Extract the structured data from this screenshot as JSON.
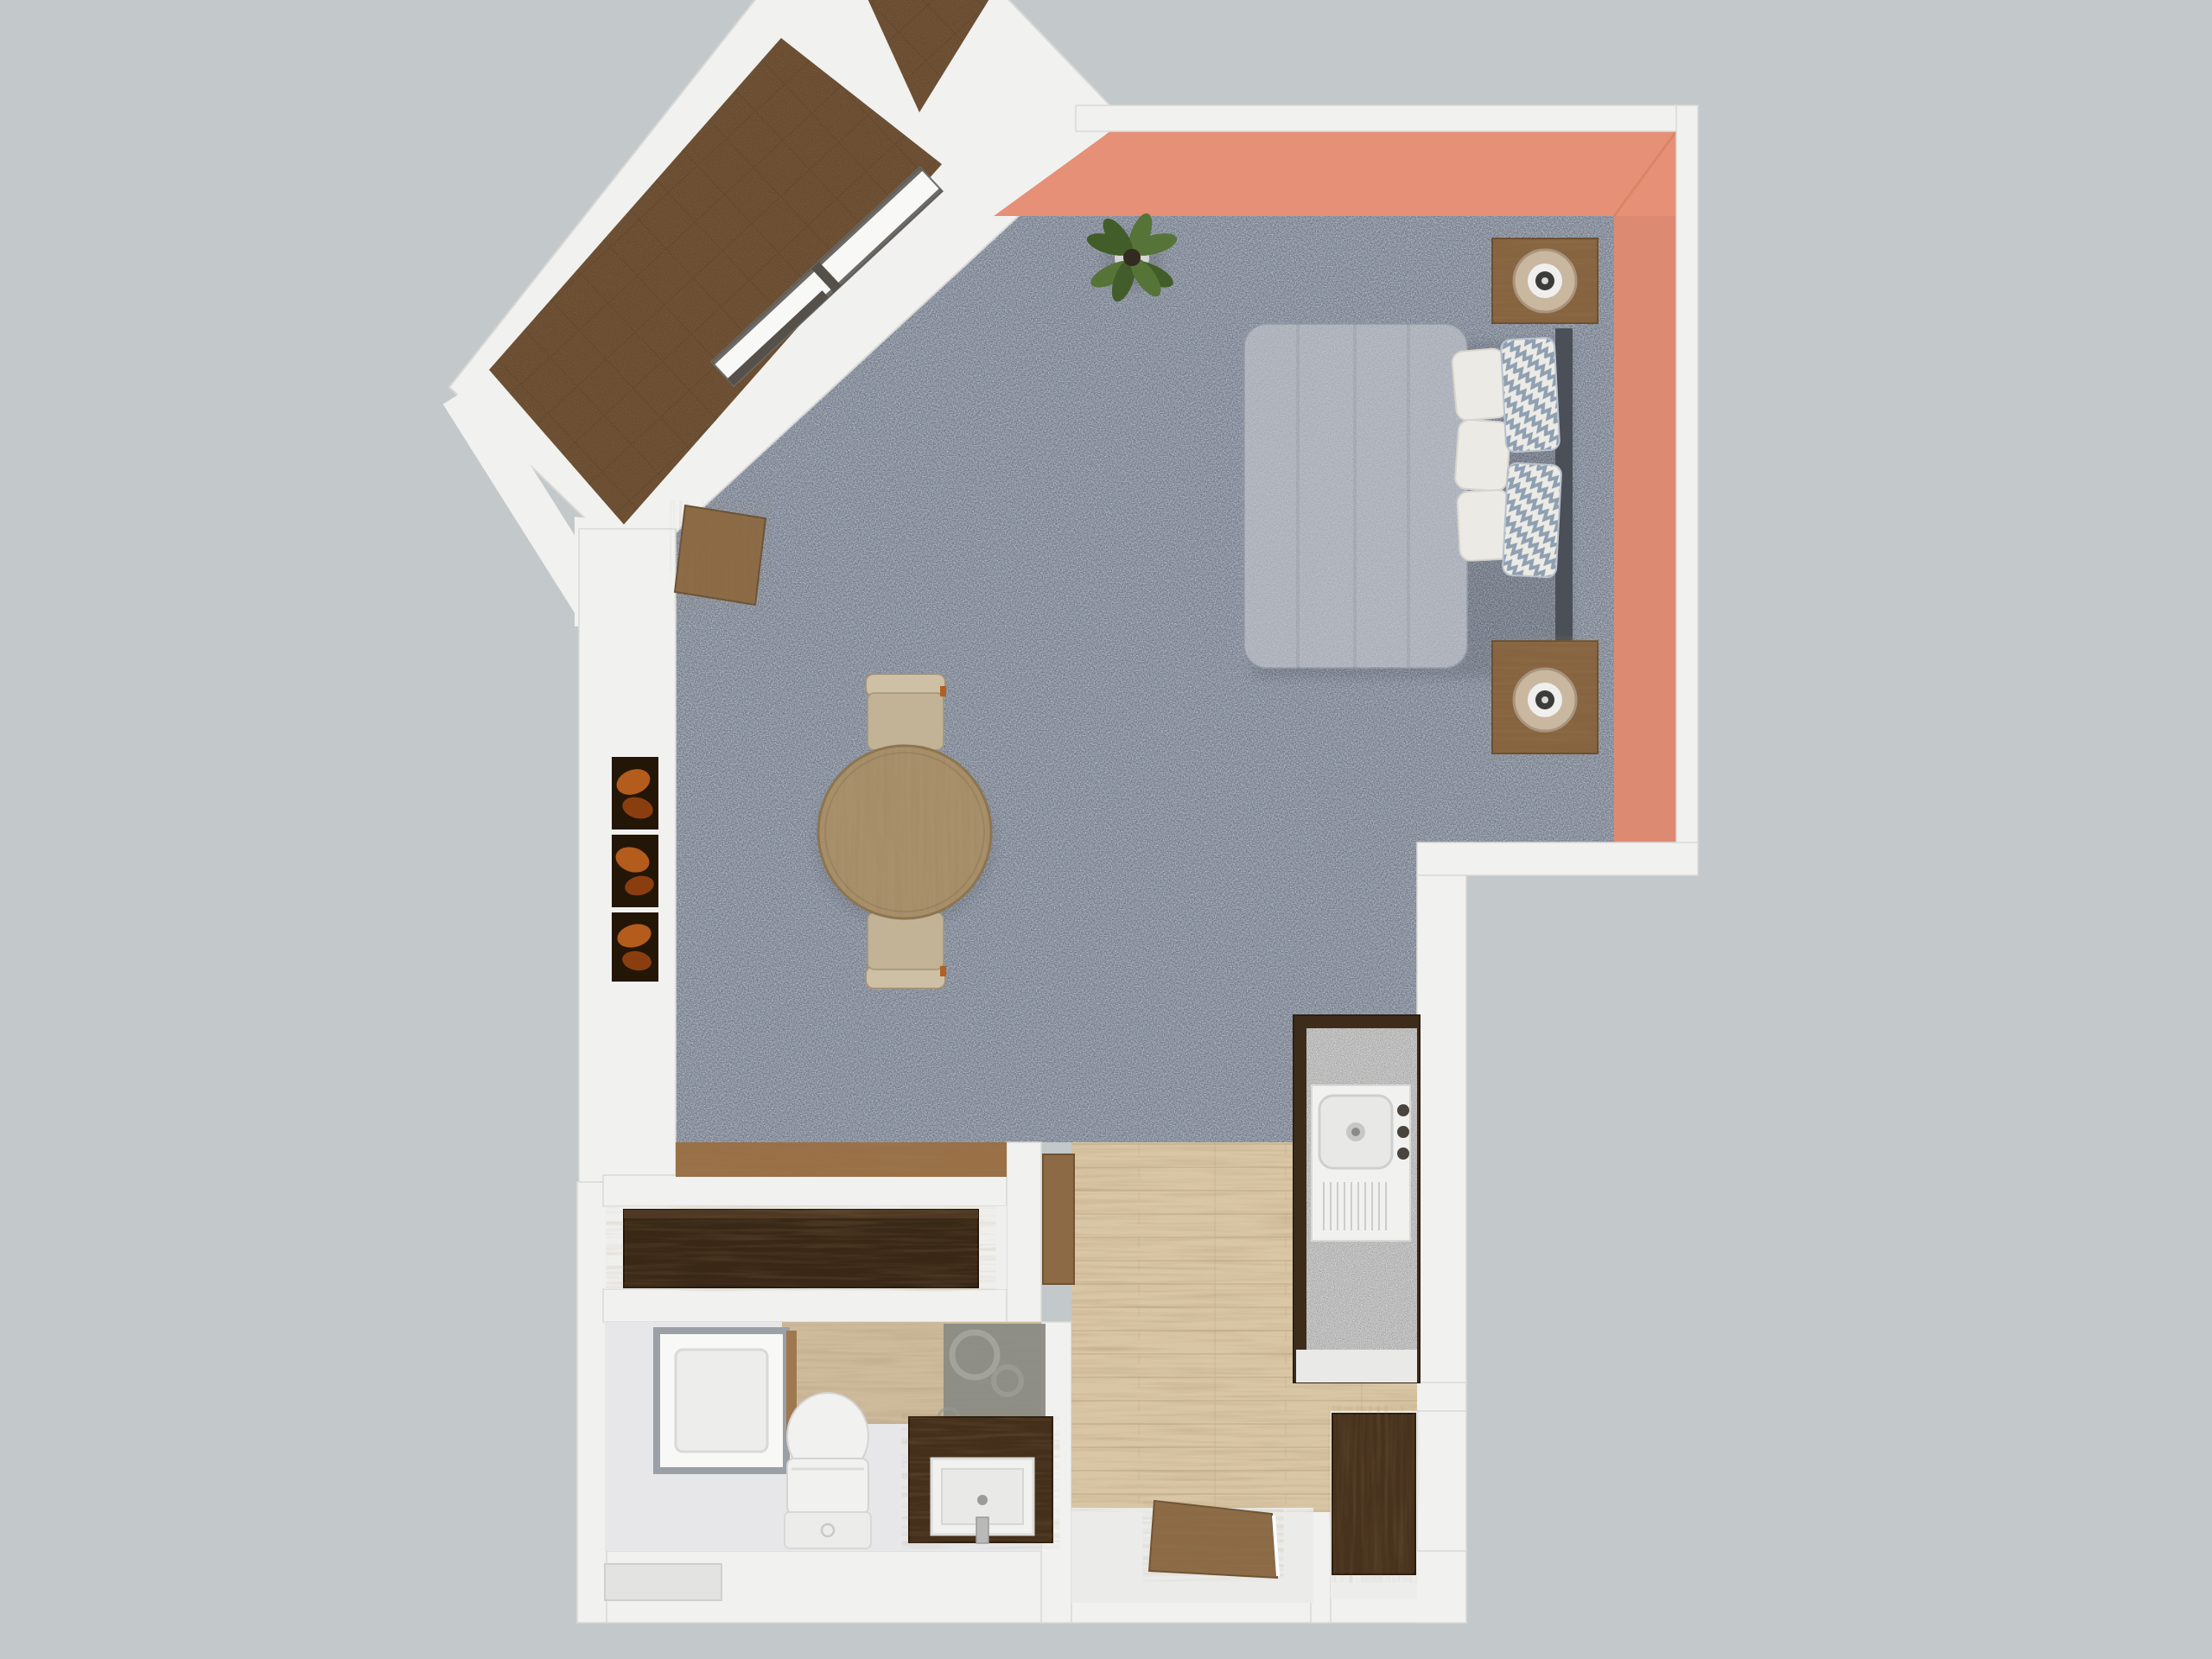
{
  "scene": {
    "title": "Top-down 3D rendered floor plan of a studio apartment",
    "type": "architectural render, no visible text",
    "background": "#c3c8ca"
  },
  "colors": {
    "background": "#c3c8ca",
    "wall": "#f1f1ef",
    "wallShade": "#e0e0de",
    "coral": "#e69077",
    "coralShade": "#d67f63",
    "carpet": "#6f7888",
    "tile": "#6b4b2c",
    "tileLine": "#593d22",
    "woodFloor": "#d9c6a4",
    "plankLine": "#c3ad88",
    "woodStrip": "#9a7047",
    "bathFloor": "#e7e7e9",
    "bathWood": "#cdbb9c",
    "granite": "#d4d4d2",
    "cabinetDark": "#3e2c1b",
    "dresser": "#3a2817",
    "wardrobe": "#47321d",
    "vanity": "#442f1b",
    "nightstand": "#876440",
    "tableWood": "#a8906a",
    "chair": "#c2b396",
    "chairBack": "#cdc0a4",
    "doorWood": "#8b6a45",
    "duvet": "#a6abb5",
    "pillow": "#eceae5",
    "chevron": "#8ea0b1",
    "headboard": "#4b5058",
    "lampShade": "#c9b7a0",
    "lampHole": "#3b3b39",
    "artOrange": "#b45c1c",
    "artFrame": "#241607",
    "leafA": "#567438",
    "leafB": "#425d2a",
    "pot": "#d6d6d4",
    "porcelain": "#f1f1ef",
    "porcelainLine": "#d4d4d2",
    "decorPanel": "#8c8c85",
    "showerFrame": "#9aa0a6",
    "stoop": "#ebebe9",
    "windowGlass": "#f8f8f6",
    "windowFrame": "#55504a"
  },
  "rooms": [
    {
      "name": "balcony",
      "floor": "brown ceramic tile, diamond grid",
      "orientation": "rotated ~43 degrees, top-left",
      "features": [
        "strip window to living room",
        "open wooden balcony door",
        "divider wall to neighbor balcony"
      ]
    },
    {
      "name": "living-bedroom-studio",
      "floor": "gray carpet",
      "accent_wall_color": "#e69077",
      "features": [
        "coral painted top and right walls"
      ]
    },
    {
      "name": "kitchen-entry",
      "floor": "light wood planks",
      "features": [
        "granite kitchenette counter",
        "entry stoop with open door"
      ]
    },
    {
      "name": "hall-closet",
      "floor": "white",
      "features": [
        "long dark dresser"
      ]
    },
    {
      "name": "bathroom",
      "floor": "white with light wood band",
      "features": [
        "shower",
        "toilet",
        "dark wood vanity",
        "gray decor panel with circles",
        "wall niche"
      ]
    },
    {
      "name": "entry-closet",
      "floor": "white",
      "features": [
        "dark wardrobe"
      ]
    }
  ],
  "furniture": [
    {
      "name": "double-bed",
      "room": "living-bedroom-studio",
      "details": "gray textured duvet, 3 white pillows, 2 gray chevron pillows, dark headboard on right"
    },
    {
      "name": "nightstand",
      "count": 2,
      "room": "living-bedroom-studio",
      "details": "wood cube with cylindrical cream lamp"
    },
    {
      "name": "potted-plant",
      "room": "living-bedroom-studio",
      "position": "corner at coral wall"
    },
    {
      "name": "round-dining-table",
      "room": "living-bedroom-studio",
      "details": "round wood top, two beige chairs"
    },
    {
      "name": "wall-art",
      "count": 3,
      "room": "living-bedroom-studio",
      "details": "orange abstract prints on left wall"
    },
    {
      "name": "kitchen-counter",
      "room": "kitchen-entry",
      "details": "granite top, white sink module, round drain, 3 knobs, drainboard grooves"
    },
    {
      "name": "long-dresser",
      "room": "hall-closet"
    },
    {
      "name": "wardrobe",
      "room": "entry-closet"
    },
    {
      "name": "shower",
      "room": "bathroom"
    },
    {
      "name": "toilet",
      "room": "bathroom"
    },
    {
      "name": "vanity-with-sink",
      "room": "bathroom"
    },
    {
      "name": "entry-door",
      "state": "open",
      "material": "wood"
    },
    {
      "name": "balcony-door",
      "state": "open",
      "material": "wood"
    },
    {
      "name": "bathroom-door",
      "state": "open against wall",
      "material": "wood"
    }
  ]
}
